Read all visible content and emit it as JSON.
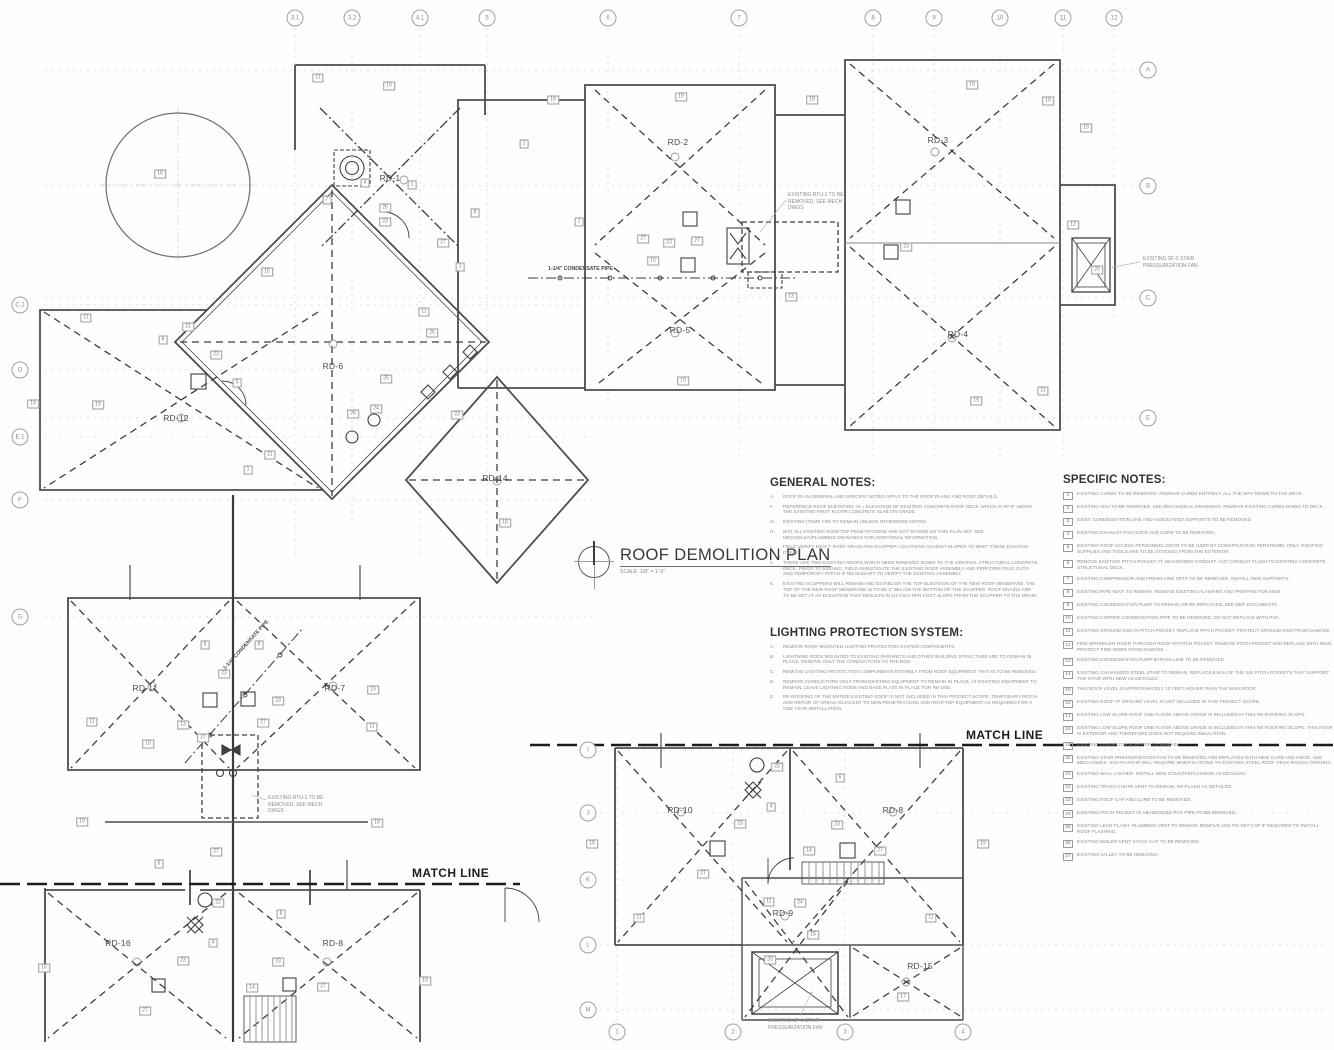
{
  "sheet": {
    "title": "ROOF DEMOLITION PLAN",
    "scale": "SCALE: 1/8\" = 1'-0\""
  },
  "notes": {
    "general": {
      "heading": "GENERAL NOTES:",
      "items": [
        {
          "letter": "A.",
          "text": "ROOF PLAN GENERAL AND SPECIFIC NOTES APPLY TO THE ROOF PLANS AND ROOF DETAILS."
        },
        {
          "letter": "F.",
          "text": "REFERENCE ROOF ELEVATION +0 = ELEVATION OF EXISTING CONCRETE ROOF DECK WHICH IS 90'-8\" ABOVE THE EXISTING FIRST FLOOR CONCRETE SLAB ON GRADE."
        },
        {
          "letter": "G.",
          "text": "EXISTING ITEMS ARE TO REMAIN UNLESS OTHERWISE NOTED."
        },
        {
          "letter": "H.",
          "text": "NOT ALL EXISTING ROOFTOP PENETRATIONS ARE NOT SHOWN ON THIS PLAN SET. SEE MECH/ELEC/PLUMBING DRAWINGS FOR ADDITIONAL INFORMATION."
        },
        {
          "letter": "I.",
          "text": "FIELD VERIFY EXACT ROOF DRAIN AND SCUPPER LOCATIONS AGAINST SLOPES TO MEET THESE EXISTING ITEMS."
        },
        {
          "letter": "J.",
          "text": "THERE ARE TWO EXISTING ROOFS WHICH NEED REMOVED DOWN TO THE ORIGINAL STRUCTURAL CONCRETE DECK. PRIOR TO BIDDING, FIELD INVESTIGATE THE EXISTING ROOF ASSEMBLY AND PERFORM FIELD CUTS AND TEMPORARY PATCH IF NECESSARY TO VERIFY THE EXISTING ASSEMBLY."
        },
        {
          "letter": "K.",
          "text": "EXISTING SCUPPERS WILL REMAIN AND ESTABLISH THE TOP ELEVATION OF THE NEW ROOF MEMBRANE. THE TOP OF THE NEW ROOF MEMBRANE IS TO BE 1\" BELOW THE BOTTOM OF THE SCUPPER. ROOF DRAINS ARE TO BE SET AT AN ELEVATION THAT RESULTS IN 1/4 INCH PER FOOT SLOPE FROM THE SCUPPER TO THE DRAIN."
        }
      ]
    },
    "lighting": {
      "heading": "LIGHTING PROTECTION SYSTEM:",
      "items": [
        {
          "letter": "A.",
          "text": "REMOVE ROOF MOUNTED LIGHTING PROTECTION SYSTEM COMPONENTS."
        },
        {
          "letter": "B.",
          "text": "LIGHTNING RODS MOUNTED TO EXISTING PARAPETS AND OTHER BUILDING STRUCTURE ARE TO REMAIN IN PLACE. REMOVE ONLY THE CONDUCTORS TO THE ROD."
        },
        {
          "letter": "C.",
          "text": "REMOVE LIGHTING PROTECTION COMPONENTS ENTIRELY FROM ROOF EQUIPMENT THAT IS TO BE REMOVED."
        },
        {
          "letter": "D.",
          "text": "REMOVE CONDUCTORS ONLY FROM EXISTING EQUIPMENT TO REMAIN IN PLACE. AT EXISTING EQUIPMENT TO REMAIN, LEAVE LIGHTING RODS AND BASE PLATE IN PLACE FOR RE-USE."
        },
        {
          "letter": "E.",
          "text": "RE-ROOFING OF THE ENTIRE EXISTING ROOF IS NOT INCLUDED IN THIS PROJECT SCOPE. TEMPORARY PATCH AND REPAIR OF AREAS ADJACENT TO NEW PENETRATIONS AND ROOFTOP EQUIPMENT AS REQUIRED FOR A ONE YEAR INSTALLATION."
        }
      ]
    },
    "specific": {
      "heading": "SPECIFIC NOTES:",
      "items": [
        {
          "num": "1",
          "text": "EXISTING CURBS TO BE REMOVED. REMOVE CURBS ENTIRELY, ALL THE WAY DOWN TO THE DECK."
        },
        {
          "num": "2",
          "text": "EXISTING AHU TO BE REMOVED, SEE MECHANICAL DRAWINGS. REMOVE EXISTING CURBS DOWN TO DECK."
        },
        {
          "num": "3",
          "text": "EXIST. CONDENSATION LINE AND ASSOCIATED SUPPORTS TO BE REMOVED."
        },
        {
          "num": "4",
          "text": "EXISTING EXHAUST FAN HOOD AND CURB TO BE REMOVED."
        },
        {
          "num": "5",
          "text": "EXISTING ROOF ACCESS PERSONNEL DOOR TO BE USED BY CONSTRUCTION PERSONNEL ONLY. ROOFING SUPPLIES AND TOOLS ARE TO BE STOCKED FROM THE EXTERIOR."
        },
        {
          "num": "6",
          "text": "REMOVE EXISTING PITCH POCKET AT ABANDONED CONDUIT. CUT CONDUIT FLUSH TO EXISTING CONCRETE STRUCTURAL DECK."
        },
        {
          "num": "7",
          "text": "EXISTING COMPRESSOR AND FREON LINE SETS TO BE REMOVED. INSTALL NEW SUPPORTS."
        },
        {
          "num": "8",
          "text": "EXISTING PIPE VENT TO REMAIN. REMOVE EXISTING FLASHING AND PREPARE FOR NEW."
        },
        {
          "num": "9",
          "text": "EXISTING CONDENSATION PUMP TO REMAIN OR BE REPLACED, SEE MEP DOCUMENTS."
        },
        {
          "num": "10",
          "text": "EXISTING COPPER CONDENSATION PIPE TO BE REMOVED. DO NOT REPLACE WITH PVC."
        },
        {
          "num": "11",
          "text": "EXISTING GROUND ROD IN PITCH POCKET. REPLACE PITCH POCKET. PROTECT GROUND ROD FROM DAMAGE."
        },
        {
          "num": "12",
          "text": "FIRE SPRINKLER RISER THROUGH ROOF IN PITCH POCKET. REMOVE PITCH POCKET AND REPLACE WITH NEW. PROTECT FIRE RISER FROM DAMAGE."
        },
        {
          "num": "13",
          "text": "EXISTING CONDENSATION PUMP BYPASS LINE TO BE REMOVED."
        },
        {
          "num": "14",
          "text": "EXISTING GALVANIZED STEEL STAIR TO REMAIN. REPLACE EACH OF THE SIX PITCH POCKETS THAT SUPPORT THE STAIR WITH NEW AS DETAILED."
        },
        {
          "num": "15",
          "text": "THIS ROOF LEVEL IS APPROXIMATELY 12 FEET HIGHER THAN THE MAIN ROOF."
        },
        {
          "num": "16",
          "text": "EXISTING ROOF AT GROUND LEVEL IS NOT INCLUDED IN THIS PROJECT SCOPE."
        },
        {
          "num": "17",
          "text": "EXISTING LOW SLOPE ROOF ONE FLOOR ABOVE GRADE IS INCLUDED IN THIS RE-ROOFING SCOPE."
        },
        {
          "num": "18",
          "text": "EXISTING LOW SLOPE ROOF ONE FLOOR ABOVE GRADE IS INCLUDED IN THIS RE-ROOFING SCOPE. THIS ROOF IS EXTERIOR AND THEREFORE DOES NOT REQUIRE INSULATION."
        },
        {
          "num": "19",
          "text": "EXISTING OVERFLOW SCUPPER TO REMAIN."
        },
        {
          "num": "20",
          "text": "EXISTING STAIR PRESSURIZATION FAN TO BE REMOVED AND REPLACED WITH NEW CURB AND HOOD, SEE MECH DWGS. SOUTH STAIR WILL REQUIRE MODIFICATIONS TO EXISTING STEEL ROOF DECK ROUGH OPENING."
        },
        {
          "num": "21",
          "text": "EXISTING WALL LOUVER. INSTALL NEW COUNTERFLASHING AS DETAILED."
        },
        {
          "num": "22",
          "text": "EXISTING TRASH CHUTE VENT TO REMAIN. RE-FLASH AS DETAILED."
        },
        {
          "num": "23",
          "text": "EXISTING ROOF CAP AND CURB TO BE REMOVED."
        },
        {
          "num": "24",
          "text": "EXISTING PITCH POCKET AT ABANDONED PVC PIPE TO BE REMOVED."
        },
        {
          "num": "25",
          "text": "EXISTING LEAD FLASH- PLUMBING VENT TO REMAIN. REMOVE AND RE-SET CAP IF REQUIRED TO INSTALL ROOF FLASHING."
        },
        {
          "num": "26",
          "text": "EXISTING BOILER VENT STACK CAP TO BE REMOVED."
        },
        {
          "num": "27",
          "text": "EXISTING VALLEY TO BE REMOVED."
        }
      ]
    }
  },
  "grid": {
    "top": [
      {
        "label": "3.1",
        "x": 295
      },
      {
        "label": "3.2",
        "x": 352
      },
      {
        "label": "4.1",
        "x": 420
      },
      {
        "label": "5",
        "x": 487
      },
      {
        "label": "6",
        "x": 608
      },
      {
        "label": "7",
        "x": 739
      },
      {
        "label": "8",
        "x": 873
      },
      {
        "label": "9",
        "x": 934
      },
      {
        "label": "10",
        "x": 1000
      },
      {
        "label": "11",
        "x": 1063
      },
      {
        "label": "12",
        "x": 1114
      }
    ],
    "right": [
      {
        "label": "A",
        "y": 70
      },
      {
        "label": "B",
        "y": 186
      },
      {
        "label": "C",
        "y": 298
      },
      {
        "label": "E",
        "y": 418
      }
    ],
    "left": [
      {
        "label": "C.1",
        "y": 305
      },
      {
        "label": "D",
        "y": 370
      },
      {
        "label": "E.1",
        "y": 437
      },
      {
        "label": "F",
        "y": 500
      },
      {
        "label": "G",
        "y": 617
      }
    ],
    "inner_letters": [
      {
        "label": "I",
        "y": 750
      },
      {
        "label": "J",
        "y": 813
      },
      {
        "label": "K",
        "y": 880
      },
      {
        "label": "L",
        "y": 945
      },
      {
        "label": "M",
        "y": 1010
      }
    ],
    "inner_numbers": [
      {
        "label": "1",
        "x": 617
      },
      {
        "label": "2",
        "x": 733
      },
      {
        "label": "3",
        "x": 845
      },
      {
        "label": "4",
        "x": 963
      }
    ]
  },
  "plan": {
    "rd_labels": [
      {
        "label": "RD-1",
        "x": 390,
        "y": 178
      },
      {
        "label": "RD-2",
        "x": 678,
        "y": 142
      },
      {
        "label": "RD-3",
        "x": 938,
        "y": 140
      },
      {
        "label": "RD-4",
        "x": 958,
        "y": 334
      },
      {
        "label": "RD-5",
        "x": 680,
        "y": 330
      },
      {
        "label": "RD-6",
        "x": 333,
        "y": 366
      },
      {
        "label": "RD-12",
        "x": 176,
        "y": 418
      },
      {
        "label": "RD-14",
        "x": 495,
        "y": 478
      },
      {
        "label": "RD-11",
        "x": 145,
        "y": 688
      },
      {
        "label": "RD-7",
        "x": 335,
        "y": 688
      },
      {
        "label": "RD-16",
        "x": 118,
        "y": 943
      },
      {
        "label": "RD-8",
        "x": 333,
        "y": 943
      },
      {
        "label": "RD-10",
        "x": 680,
        "y": 810
      },
      {
        "label": "RD-8",
        "x": 893,
        "y": 810
      },
      {
        "label": "RD-9",
        "x": 783,
        "y": 913
      },
      {
        "label": "RD-15",
        "x": 920,
        "y": 966
      }
    ],
    "keynotes": [
      {
        "n": "11",
        "x": 318,
        "y": 78
      },
      {
        "n": "19",
        "x": 389,
        "y": 86
      },
      {
        "n": "19",
        "x": 553,
        "y": 100
      },
      {
        "n": "19",
        "x": 681,
        "y": 97
      },
      {
        "n": "19",
        "x": 812,
        "y": 100
      },
      {
        "n": "19",
        "x": 972,
        "y": 85
      },
      {
        "n": "19",
        "x": 1048,
        "y": 101
      },
      {
        "n": "19",
        "x": 1086,
        "y": 128
      },
      {
        "n": "1",
        "x": 524,
        "y": 144
      },
      {
        "n": "7",
        "x": 327,
        "y": 200
      },
      {
        "n": "8",
        "x": 365,
        "y": 183
      },
      {
        "n": "25",
        "x": 385,
        "y": 208
      },
      {
        "n": "1",
        "x": 412,
        "y": 185
      },
      {
        "n": "23",
        "x": 385,
        "y": 222
      },
      {
        "n": "16",
        "x": 160,
        "y": 174
      },
      {
        "n": "15",
        "x": 267,
        "y": 272
      },
      {
        "n": "27",
        "x": 443,
        "y": 243
      },
      {
        "n": "1",
        "x": 460,
        "y": 267
      },
      {
        "n": "11",
        "x": 424,
        "y": 312
      },
      {
        "n": "26",
        "x": 432,
        "y": 333
      },
      {
        "n": "8",
        "x": 475,
        "y": 213
      },
      {
        "n": "1",
        "x": 579,
        "y": 222
      },
      {
        "n": "27",
        "x": 643,
        "y": 239
      },
      {
        "n": "23",
        "x": 669,
        "y": 243
      },
      {
        "n": "27",
        "x": 697,
        "y": 241
      },
      {
        "n": "23",
        "x": 906,
        "y": 247
      },
      {
        "n": "12",
        "x": 1073,
        "y": 225
      },
      {
        "n": "20",
        "x": 1097,
        "y": 270
      },
      {
        "n": "10",
        "x": 653,
        "y": 261
      },
      {
        "n": "13",
        "x": 791,
        "y": 297
      },
      {
        "n": "21",
        "x": 188,
        "y": 327
      },
      {
        "n": "6",
        "x": 163,
        "y": 340
      },
      {
        "n": "23",
        "x": 216,
        "y": 355
      },
      {
        "n": "5",
        "x": 237,
        "y": 383
      },
      {
        "n": "11",
        "x": 86,
        "y": 318
      },
      {
        "n": "24",
        "x": 376,
        "y": 409
      },
      {
        "n": "26",
        "x": 353,
        "y": 414
      },
      {
        "n": "23",
        "x": 457,
        "y": 415
      },
      {
        "n": "25",
        "x": 386,
        "y": 379
      },
      {
        "n": "18",
        "x": 505,
        "y": 523
      },
      {
        "n": "1",
        "x": 248,
        "y": 470
      },
      {
        "n": "11",
        "x": 270,
        "y": 455
      },
      {
        "n": "19",
        "x": 33,
        "y": 404
      },
      {
        "n": "19",
        "x": 98,
        "y": 405
      },
      {
        "n": "19",
        "x": 683,
        "y": 381
      },
      {
        "n": "11",
        "x": 1043,
        "y": 391
      },
      {
        "n": "19",
        "x": 976,
        "y": 401
      },
      {
        "n": "8",
        "x": 205,
        "y": 645
      },
      {
        "n": "8",
        "x": 259,
        "y": 645
      },
      {
        "n": "23",
        "x": 224,
        "y": 674
      },
      {
        "n": "23",
        "x": 278,
        "y": 701
      },
      {
        "n": "13",
        "x": 183,
        "y": 725
      },
      {
        "n": "10",
        "x": 148,
        "y": 744
      },
      {
        "n": "27",
        "x": 203,
        "y": 738
      },
      {
        "n": "27",
        "x": 263,
        "y": 723
      },
      {
        "n": "11",
        "x": 92,
        "y": 722
      },
      {
        "n": "11",
        "x": 372,
        "y": 727
      },
      {
        "n": "19",
        "x": 373,
        "y": 690
      },
      {
        "n": "19",
        "x": 82,
        "y": 822
      },
      {
        "n": "19",
        "x": 377,
        "y": 823
      },
      {
        "n": "6",
        "x": 159,
        "y": 864
      },
      {
        "n": "27",
        "x": 216,
        "y": 852
      },
      {
        "n": "22",
        "x": 218,
        "y": 903
      },
      {
        "n": "4",
        "x": 213,
        "y": 943
      },
      {
        "n": "23",
        "x": 183,
        "y": 961
      },
      {
        "n": "27",
        "x": 145,
        "y": 1011
      },
      {
        "n": "8",
        "x": 281,
        "y": 914
      },
      {
        "n": "23",
        "x": 278,
        "y": 962
      },
      {
        "n": "27",
        "x": 323,
        "y": 987
      },
      {
        "n": "14",
        "x": 252,
        "y": 988
      },
      {
        "n": "19",
        "x": 425,
        "y": 981
      },
      {
        "n": "16",
        "x": 44,
        "y": 968
      },
      {
        "n": "22",
        "x": 777,
        "y": 767
      },
      {
        "n": "4",
        "x": 771,
        "y": 807
      },
      {
        "n": "23",
        "x": 740,
        "y": 824
      },
      {
        "n": "27",
        "x": 703,
        "y": 874
      },
      {
        "n": "19",
        "x": 592,
        "y": 844
      },
      {
        "n": "11",
        "x": 639,
        "y": 918
      },
      {
        "n": "11",
        "x": 769,
        "y": 902
      },
      {
        "n": "24",
        "x": 800,
        "y": 903
      },
      {
        "n": "14",
        "x": 809,
        "y": 851
      },
      {
        "n": "20",
        "x": 770,
        "y": 960
      },
      {
        "n": "15",
        "x": 813,
        "y": 935
      },
      {
        "n": "6",
        "x": 840,
        "y": 778
      },
      {
        "n": "23",
        "x": 837,
        "y": 825
      },
      {
        "n": "27",
        "x": 880,
        "y": 851
      },
      {
        "n": "11",
        "x": 931,
        "y": 918
      },
      {
        "n": "19",
        "x": 983,
        "y": 844
      },
      {
        "n": "17",
        "x": 903,
        "y": 997
      }
    ],
    "annotations": [
      {
        "text": "EXISTING RTU-1 TO BE\nREMOVED, SEE MECH\nDWGS",
        "x": 788,
        "y": 192
      },
      {
        "text": "EXISTING RTU-1 TO BE\nREMOVED, SEE MECH\nDWGS",
        "x": 268,
        "y": 795
      },
      {
        "text": "EXISTING SF-2 STAIR\nPRESSURIZATION FAN",
        "x": 1143,
        "y": 256
      },
      {
        "text": "EXISTING SF-1 STAIR\nPRESSURIZATION FAN",
        "x": 768,
        "y": 1018
      },
      {
        "text": "1-1/4\" CONDENSATE PIPE",
        "x": 548,
        "y": 266,
        "cls": "pipe"
      },
      {
        "text": "1-1/4\" CONDENSATE PIPE",
        "x": 214,
        "y": 642,
        "cls": "pipe",
        "rotate": -48
      },
      {
        "text": "MATCH LINE",
        "x": 412,
        "y": 866,
        "cls": "match"
      },
      {
        "text": "MATCH LINE",
        "x": 966,
        "y": 728,
        "cls": "match"
      }
    ]
  }
}
